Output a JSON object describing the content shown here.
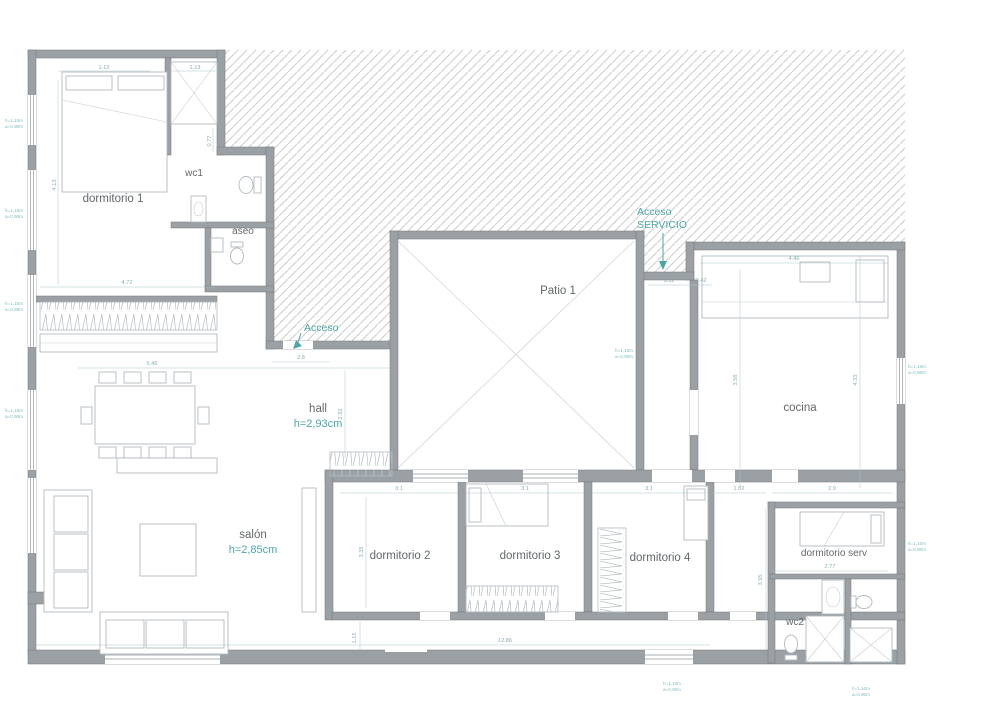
{
  "drawing": {
    "type": "residential floor plan",
    "rooms": [
      {
        "id": "dormitorio-1",
        "label": "dormitorio 1"
      },
      {
        "id": "wc1",
        "label": "wc1"
      },
      {
        "id": "aseo",
        "label": "aseo"
      },
      {
        "id": "patio-1",
        "label": "Patio 1"
      },
      {
        "id": "cocina",
        "label": "cocina"
      },
      {
        "id": "hall",
        "label": "hall",
        "height": "h=2,93cm"
      },
      {
        "id": "salon",
        "label": "salón",
        "height": "h=2,85cm"
      },
      {
        "id": "dormitorio-2",
        "label": "dormitorio 2"
      },
      {
        "id": "dormitorio-3",
        "label": "dormitorio 3"
      },
      {
        "id": "dormitorio-4",
        "label": "dormitorio 4"
      },
      {
        "id": "dormitorio-serv",
        "label": "dormitorio serv"
      },
      {
        "id": "wc2",
        "label": "wc2"
      }
    ],
    "access": {
      "main": "Acceso",
      "service_line1": "Acceso",
      "service_line2": "SERVICIO"
    },
    "dimensions": [
      "1.12",
      "1.13",
      "4.13",
      "0.77",
      "4.72",
      "5.46",
      "2.8",
      "2.92",
      "3.11",
      "0.42",
      "4.46",
      "3.58",
      "4.33",
      "1.02",
      "2.9",
      "3.1",
      "3.1",
      "3.1",
      "3.35",
      "2.77",
      "12.86",
      "1.15",
      "3.95"
    ],
    "window_note": {
      "line1": "h=1,10m",
      "line2": "a=0,90m"
    },
    "colors": {
      "teal_accent": "#4da6a6",
      "label_gray": "#63686b",
      "wall_gray": "#9aa0a4",
      "dim_teal": "#85aeb1",
      "hatch_gray": "#cdcdcd"
    }
  }
}
